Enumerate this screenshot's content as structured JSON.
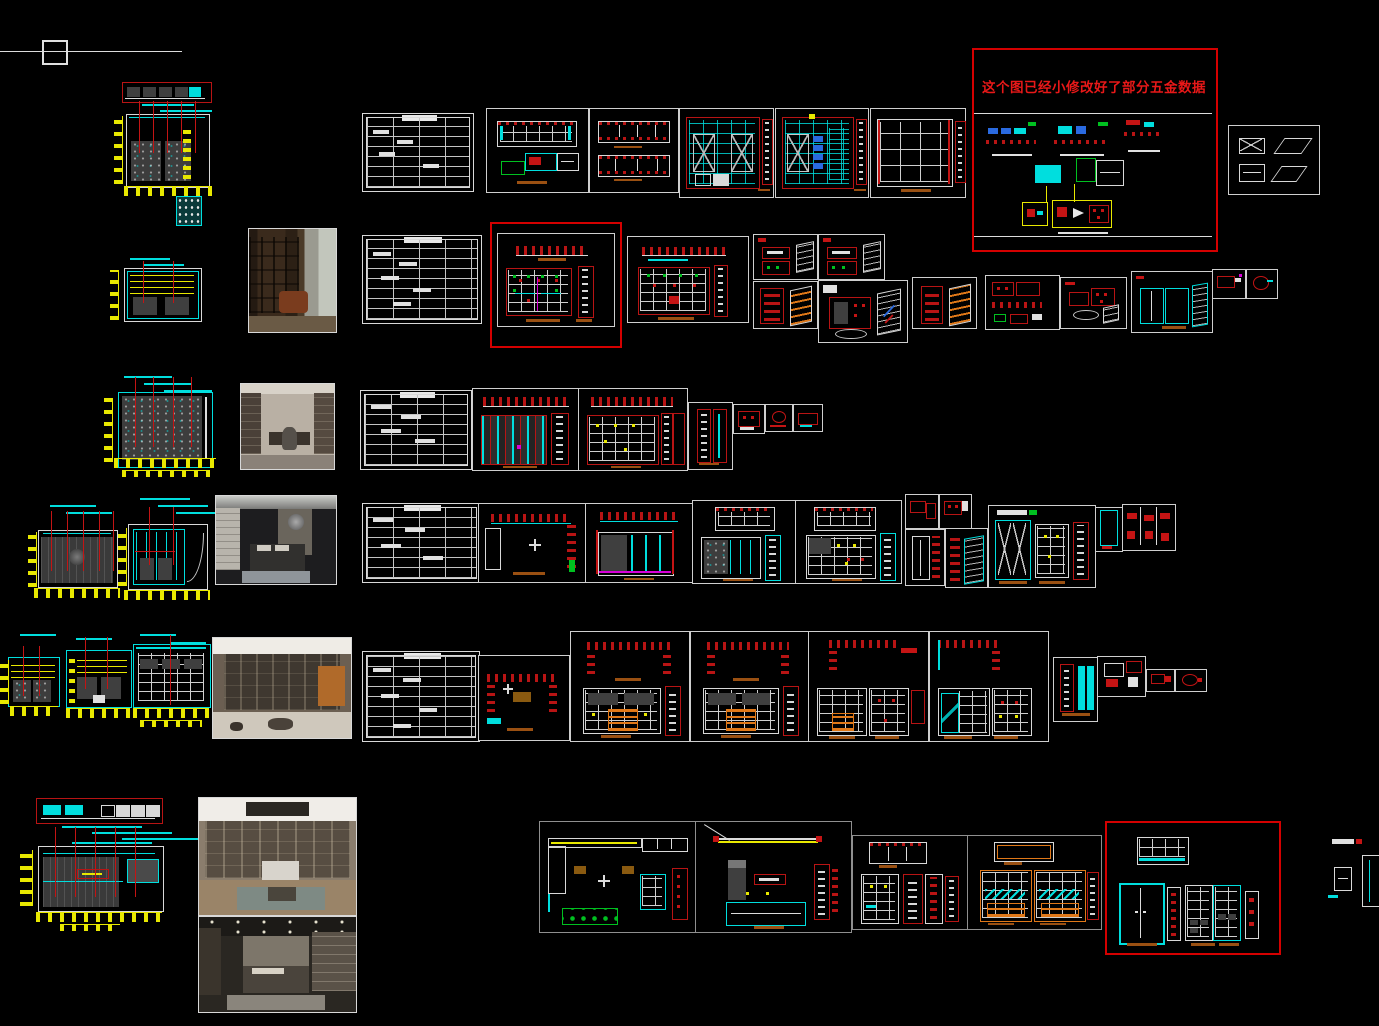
{
  "canvas": {
    "background": "#000000",
    "width": 1379,
    "height": 1026
  },
  "revision_box": {
    "note": "这个图已经小修改好了部分五金数据",
    "note_color": "#e81818",
    "border_color": "#d40000"
  },
  "palette": {
    "line_white": "#dcdcdc",
    "red": "#c41414",
    "dark_red": "#b81414",
    "cyan": "#00dede",
    "yellow": "#e8e800",
    "green": "#00c020",
    "magenta": "#d800d8",
    "orange": "#e07818",
    "brown_scale_bar": "#9a5012",
    "panel_gray": "#3f3f3f"
  }
}
